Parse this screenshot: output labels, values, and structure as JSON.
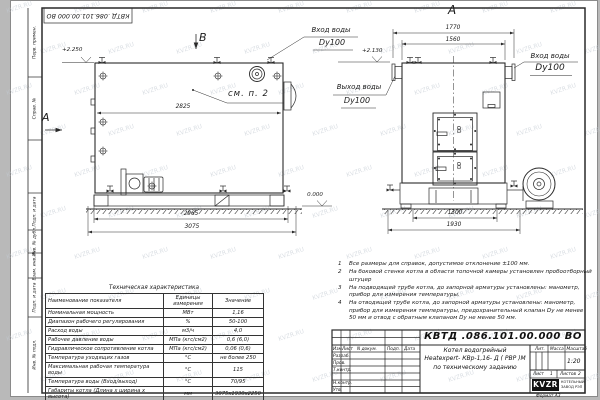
{
  "doc_code": "КВТД .086.101.00.000  ВО",
  "watermark": "KVZR.RU",
  "stamp_side": [
    {
      "label": "Перв. примен."
    },
    {
      "label": "Справ. №"
    },
    {
      "label": "Подп. и дата"
    },
    {
      "label": "Инв. № дубл."
    },
    {
      "label": "Взам. инв. №"
    },
    {
      "label": "Подп. и дата"
    },
    {
      "label": "Инв. № подл."
    }
  ],
  "views": {
    "side_arrow": "А",
    "top_arrow": "В",
    "front_title": "А",
    "see_note": "см. п. 2"
  },
  "callouts": {
    "inlet_top1": "Вход воды",
    "inlet_top2": "Dy100",
    "outlet1": "Выход воды",
    "outlet2": "Dy100",
    "inlet_right1": "Вход воды",
    "inlet_right2": "Dy100"
  },
  "elevations": {
    "side_top": "+2.250",
    "front_top": "+2.130",
    "ground": "0.000"
  },
  "dims": {
    "d2825": "2825",
    "d2965": "2965",
    "d3075": "3075",
    "d1770": "1770",
    "d1560": "1560",
    "d1300": "1300",
    "d1930": "1930"
  },
  "notes": [
    {
      "n": "1",
      "t": "Все размеры для справок, допустимое отклонение ±100 мм."
    },
    {
      "n": "2",
      "t": "На боковой стенке котла в области топочной камеры установлен пробоотборный штуцер"
    },
    {
      "n": "3",
      "t": "На подводящей трубе котла, до запорной арматуры установлены: манометр, прибор для измерения температуры."
    },
    {
      "n": "4",
      "t": "На отводящей трубе котла, до запорной арматуры установлены: манометр, прибор для измерения температуры, предохранительный клапан Dу не менее 50 мм и отвод с обратным клапаном Dу не менее 50 мм."
    }
  ],
  "table": {
    "title": "Техническая характеристика",
    "headers": [
      "Наименование показателя",
      "Единицы измерения",
      "Значение"
    ],
    "rows": [
      {
        "name": "Номинальная мощность",
        "unit": "МВт",
        "value": "1,16"
      },
      {
        "name": "Диапазон рабочего регулирования",
        "unit": "%",
        "value": "50-100"
      },
      {
        "name": "Расход воды",
        "unit": "м3/ч",
        "value": "4,0"
      },
      {
        "name": "Рабочее давление воды",
        "unit": "МПа (кгс/см2)",
        "value": "0,6 (6,0)"
      },
      {
        "name": "Гидравлическое сопротивление котла",
        "unit": "МПа (кгс/см2)",
        "value": "0,06 (0,6)"
      },
      {
        "name": "Температура уходящих газов",
        "unit": "°С",
        "value": "не более 250"
      },
      {
        "name": "Максимальная рабочая температура воды",
        "unit": "°С",
        "value": "115"
      },
      {
        "name": "Температура воды (Вход/выход)",
        "unit": "°С",
        "value": "70/95"
      },
      {
        "name": "Габариты котла (Длина х ширина х высота)",
        "unit": "мм",
        "value": "3075х1930х2250"
      }
    ]
  },
  "title_block": {
    "code": "КВТД .086.101.00.000  ВО",
    "product1": "Котел водогрейный",
    "product2": "Heatexpert- КВр-1,16- Д ( РВР )М",
    "product3": "по техническому заданию",
    "col_izm": "Изм.",
    "col_list": "Лист",
    "col_doc": "N докум.",
    "col_podp": "Подп.",
    "col_data": "Дата",
    "row1": "Разраб.",
    "row2": "Пров.",
    "row3": "Т.контр.",
    "row4": "Н.контр.",
    "row5": "Утв.",
    "lit": "Лит.",
    "mass": "Масса",
    "scale_label": "Масштаб",
    "scale": "1:20",
    "sheet_label": "Лист",
    "sheet": "1",
    "sheets_label": "Листов",
    "sheets": "2",
    "logo": "KVZR",
    "company1": "КОТЕЛЬНЫЙ",
    "company2": "ЗАВОД РЭП",
    "format": "Формат  А3"
  }
}
